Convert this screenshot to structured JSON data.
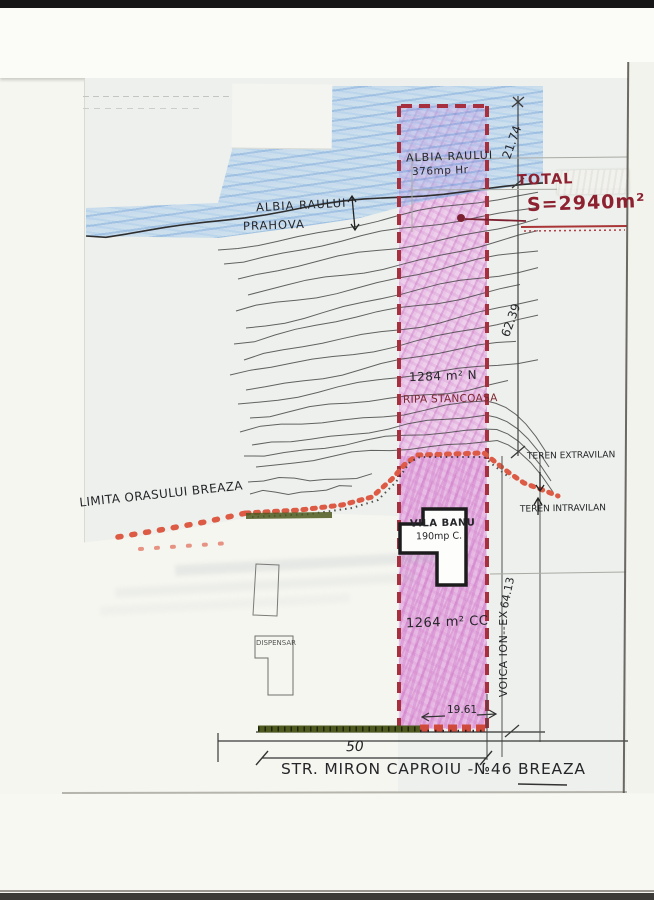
{
  "labels": {
    "albia_parcel_1": "ALBIA RAULUI",
    "albia_parcel_2": "376mp Hr",
    "albia_river_1": "ALBIA RAULUI",
    "albia_river_2": "PRAHOVA",
    "total": "TOTAL",
    "area_total": "S=2940m²",
    "dim_21": "21.74",
    "dim_62": "62.39",
    "dim_64": "64.13",
    "parcel_upper_area": "1284 m² N",
    "parcel_upper_name": "RIPA STANCOASA",
    "teren_extravilan": "TEREN EXTRAVILAN",
    "teren_intravilan": "TEREN INTRAVILAN",
    "limita": "LIMITA ORASULUI BREAZA",
    "vila_name": "VILA BANU",
    "vila_area": "190mp C.",
    "parcel_lower_area": "1264 m² CC",
    "neighbor": "VOICA ION--EX",
    "dispensar": "DISPENSAR",
    "dim_1961": "19.61",
    "dim_50": "50",
    "street": "STR. MIRON CAPROIU  -№46  BREAZA"
  },
  "colors": {
    "parcel_pink": "#eccdea",
    "river_blue": "#9ec8ee",
    "parcel_border_red": "#a6303e",
    "limit_dot_red": "#dd5a45",
    "stamp_red": "#8e2130",
    "hatch_green": "#4d591f",
    "ink": "#26262a"
  }
}
